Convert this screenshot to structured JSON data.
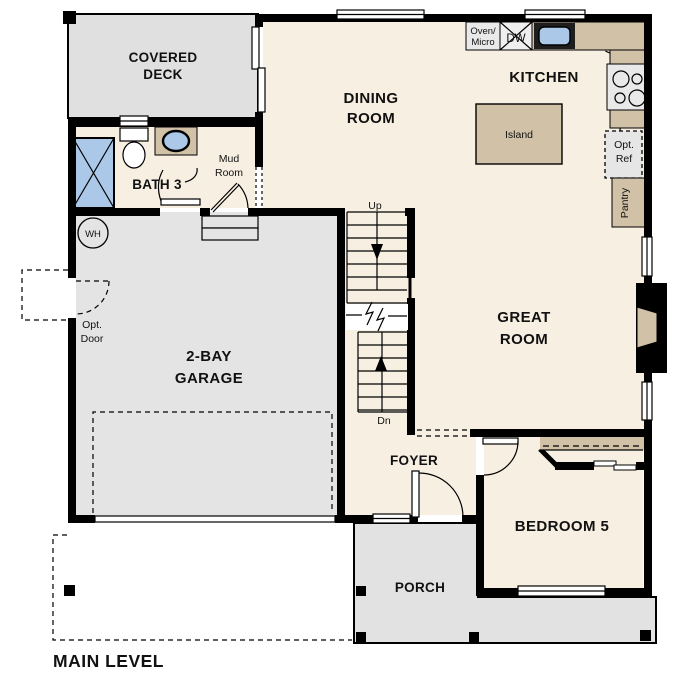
{
  "title": "MAIN LEVEL",
  "colors": {
    "interior_cream": "#f7efe2",
    "deck_gray": "#e0e0e0",
    "garage_gray": "#e4e4e4",
    "porch_gray": "#e2e2e2",
    "counter_tan": "#d0c1a7",
    "fixture_blue": "#abc8e8",
    "appliance_gray": "#e9e9e9",
    "wall_black": "#000000"
  },
  "labels": {
    "covered_deck_1": "COVERED",
    "covered_deck_2": "DECK",
    "dining_1": "DINING",
    "dining_2": "ROOM",
    "kitchen": "KITCHEN",
    "island": "Island",
    "oven_micro_1": "Oven/",
    "oven_micro_2": "Micro",
    "dw": "DW",
    "opt_ref_1": "Opt.",
    "opt_ref_2": "Ref",
    "pantry": "Pantry",
    "mud_room_1": "Mud",
    "mud_room_2": "Room",
    "bath3": "BATH 3",
    "wh": "WH",
    "opt_door_1": "Opt.",
    "opt_door_2": "Door",
    "garage_1": "2-BAY",
    "garage_2": "GARAGE",
    "up": "Up",
    "dn": "Dn",
    "great_room_1": "GREAT",
    "great_room_2": "ROOM",
    "foyer": "FOYER",
    "bedroom5": "BEDROOM 5",
    "porch": "PORCH",
    "main_level": "MAIN LEVEL"
  }
}
